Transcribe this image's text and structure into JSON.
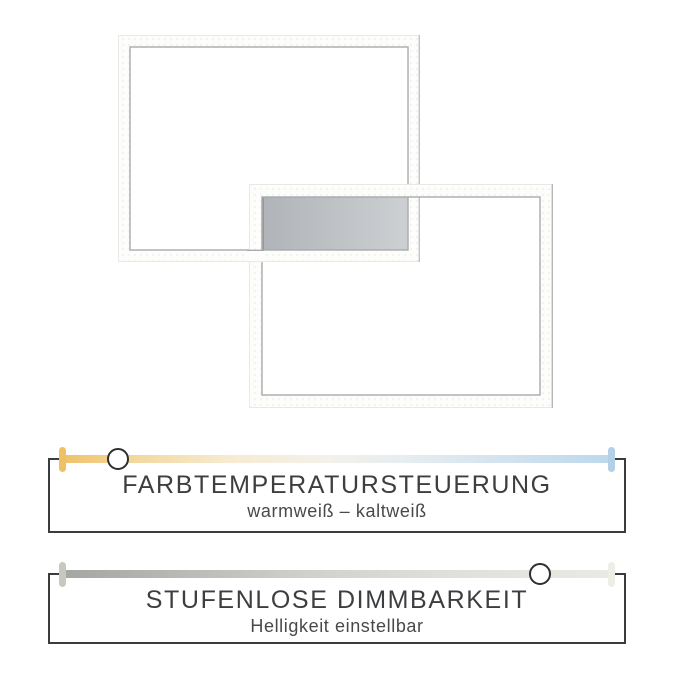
{
  "lamp": {
    "style": "two-overlapping-rectangular-led-frames",
    "frame_color": "#fdfdfb",
    "frame_edge_color": "#a7aaac",
    "canopy_gradient_left": "#b0b3b7",
    "canopy_gradient_right": "#cdd0d3"
  },
  "panels": [
    {
      "title": "FARBTEMPERATURSTEUERUNG",
      "subtitle": "warmweiß – kaltweiß",
      "slider": {
        "type": "color-temperature",
        "knob_position_percent": 10,
        "warm_color": "#eec167",
        "cold_color": "#b3d0e7"
      }
    },
    {
      "title": "STUFENLOSE DIMMBARKEIT",
      "subtitle": "Helligkeit einstellbar",
      "slider": {
        "type": "brightness",
        "knob_position_percent": 87,
        "dark_color": "#a4a7a1",
        "light_color": "#edeee6"
      }
    }
  ],
  "text_color": "#3d3e40",
  "box_border_color": "#3b3c3e",
  "background_color": "#ffffff"
}
